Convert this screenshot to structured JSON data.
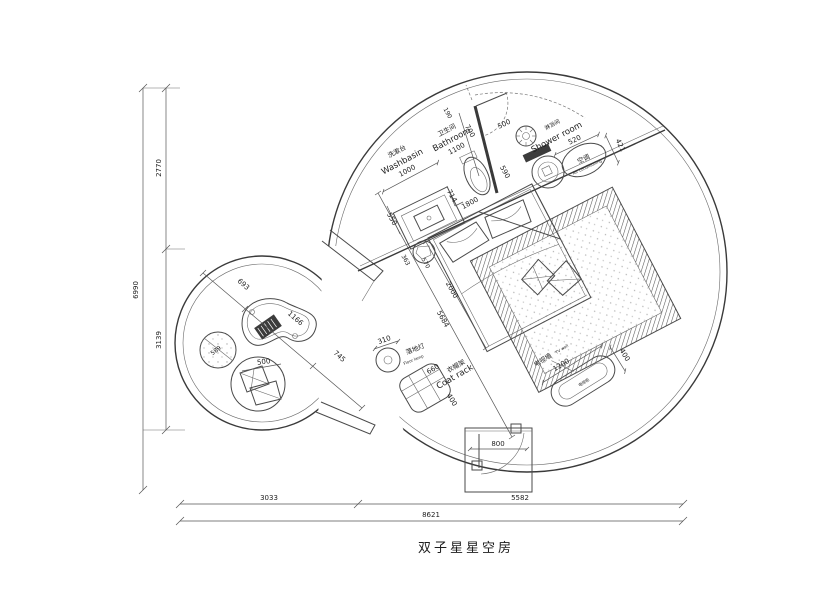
{
  "title": "双子星星空房",
  "colors": {
    "line": "#4a4a4a",
    "text": "#1d1d1d",
    "background": "#ffffff",
    "dark_fill": "#3c3c3c"
  },
  "labels": {
    "washbasin": {
      "zh": "洗漱台",
      "en": "Washbasin",
      "dim": "1000"
    },
    "bathroom": {
      "zh": "卫生间",
      "en": "Bathroom",
      "dim": "1100"
    },
    "shower_room": {
      "zh": "淋浴间",
      "en": "Shower room"
    },
    "air_conditioner": {
      "zh": "空调",
      "en": "Air conditioning"
    },
    "floor_lamp": {
      "zh": "落地灯",
      "en": "Floor lamp"
    },
    "coat_rack": {
      "zh": "衣帽架",
      "en": "Coat rack"
    },
    "tv_wall": {
      "zh": "电视墙",
      "en": "TV wall",
      "cabinet_zh": "电视柜"
    }
  },
  "dimensions": {
    "left": {
      "total": "6990",
      "upper": "2770",
      "lower": "3139"
    },
    "bottom": {
      "left": "3033",
      "right": "5582",
      "total": "8621"
    },
    "interior": {
      "wall_top": "190",
      "bath_depth": "700",
      "shower_door": "500",
      "ac_width": "520",
      "ac_depth": "421",
      "wall_590": "590",
      "toilet": "714",
      "vanity_depth": "550",
      "bed_width": "1800",
      "stool": "363",
      "stool_gap": "570",
      "bed_length": "2000",
      "diagonal": "5684",
      "entry_door": "800",
      "lamp": "310",
      "rack_width": "660",
      "rack_depth": "400",
      "tv_width": "1200",
      "tv_depth": "400"
    },
    "annex": {
      "seg1": "693",
      "seg2": "1166",
      "seg3": "745",
      "pouf": "589",
      "cushion": "500"
    }
  }
}
